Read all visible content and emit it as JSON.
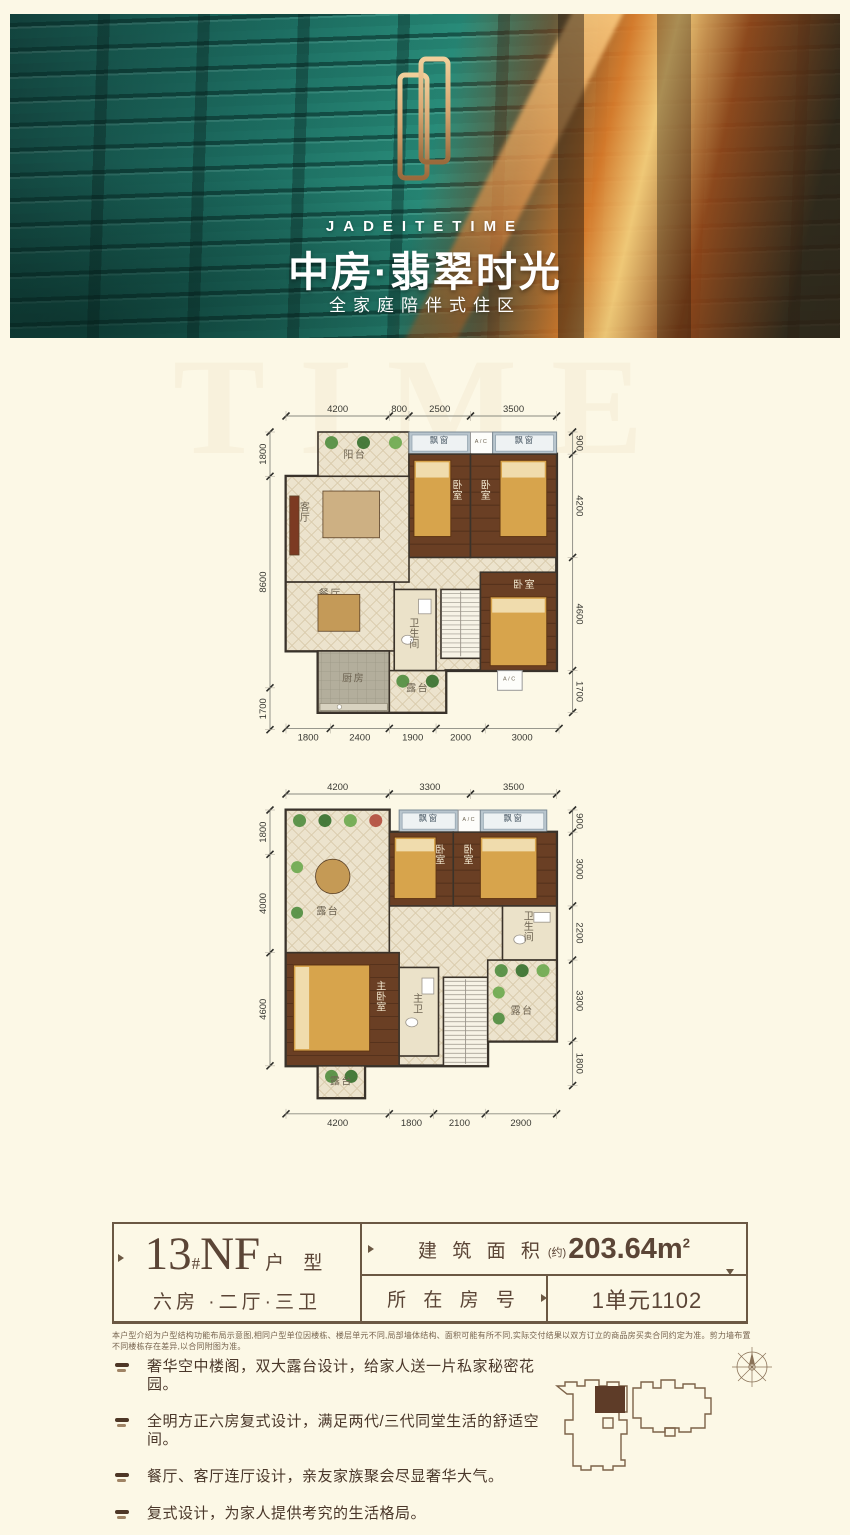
{
  "banner": {
    "en_title": "JADEITETIME",
    "cn_title": "中房·翡翠时光",
    "cn_subtitle": "全家庭陪伴式住区"
  },
  "watermark": "TIME",
  "colors": {
    "accent_brown": "#6b5843",
    "gold": "#d8a772",
    "wood": "#6a3f24",
    "teal": "#1d6e62",
    "orange": "#e27c28"
  },
  "plans": [
    {
      "name": "upper-floor-plan",
      "dims": {
        "top": [
          "4200",
          "800",
          "2500",
          "3500"
        ],
        "left": [
          "1800",
          "8600",
          "1700"
        ],
        "right": [
          "900",
          "4200",
          "4600",
          "1700"
        ],
        "bottom": [
          "1800",
          "2400",
          "1900",
          "2000",
          "3000"
        ]
      },
      "bodyH": 11400,
      "bodyPts": [
        [
          0,
          1800
        ],
        [
          5000,
          1800
        ],
        [
          5000,
          900
        ],
        [
          11000,
          900
        ],
        [
          11000,
          9700
        ],
        [
          6500,
          9700
        ],
        [
          6500,
          11400
        ],
        [
          1300,
          11400
        ],
        [
          1300,
          8900
        ],
        [
          0,
          8900
        ]
      ],
      "rooms": [
        {
          "label": "阳台",
          "x": 1300,
          "y": 0,
          "w": 3700,
          "h": 1800,
          "type": "tile-plants",
          "lx": 2800,
          "ly": 1050
        },
        {
          "label": "飘窗",
          "x": 5000,
          "y": 0,
          "w": 2500,
          "h": 900,
          "type": "bay"
        },
        {
          "label": "A/C",
          "x": 7500,
          "y": 0,
          "w": 900,
          "h": 900,
          "type": "ac"
        },
        {
          "label": "飘窗",
          "x": 8400,
          "y": 0,
          "w": 2600,
          "h": 900,
          "type": "bay"
        },
        {
          "label": "卧室",
          "x": 5000,
          "y": 900,
          "w": 2500,
          "h": 4200,
          "type": "wood",
          "vert": true,
          "lx": 7000,
          "ly": 2300,
          "bed": [
            5200,
            1150,
            1500,
            3100,
            "top"
          ]
        },
        {
          "label": "卧室",
          "x": 7500,
          "y": 900,
          "w": 3500,
          "h": 4200,
          "type": "wood",
          "vert": true,
          "lx": 8150,
          "ly": 2300,
          "bed": [
            8700,
            1150,
            1900,
            3100,
            "top"
          ]
        },
        {
          "label": "卧室",
          "x": 7900,
          "y": 5700,
          "w": 3100,
          "h": 4000,
          "type": "wood",
          "vert": false,
          "lx": 9700,
          "ly": 6350,
          "bed": [
            8300,
            6700,
            2300,
            2800,
            "top"
          ]
        },
        {
          "label": "客厅",
          "x": 0,
          "y": 1800,
          "w": 5000,
          "h": 4300,
          "type": "tile",
          "vert": true,
          "lx": 800,
          "ly": 3200
        },
        {
          "label": "餐厅",
          "x": 0,
          "y": 6100,
          "w": 4400,
          "h": 2800,
          "type": "tile",
          "lx": 1800,
          "ly": 6700
        },
        {
          "label": "卫生间",
          "x": 4400,
          "y": 6400,
          "w": 1700,
          "h": 3300,
          "type": "bath",
          "vert": true,
          "lx": 5250,
          "ly": 7900
        },
        {
          "label": "",
          "x": 6300,
          "y": 6400,
          "w": 1600,
          "h": 2800,
          "type": "stairs"
        },
        {
          "label": "厨房",
          "x": 1300,
          "y": 8900,
          "w": 2900,
          "h": 2500,
          "type": "kitchen",
          "lx": 2750,
          "ly": 10150
        },
        {
          "label": "露台",
          "x": 4200,
          "y": 9700,
          "w": 2300,
          "h": 1700,
          "type": "tile-plants",
          "lx": 5350,
          "ly": 10550
        },
        {
          "label": "A/C",
          "x": 8600,
          "y": 9700,
          "w": 1000,
          "h": 800,
          "type": "ac"
        }
      ],
      "deco": [
        {
          "t": "rect",
          "x": 1500,
          "y": 2400,
          "w": 2300,
          "h": 1900,
          "f": "#cdb083"
        },
        {
          "t": "rect",
          "x": 150,
          "y": 2600,
          "w": 380,
          "h": 2400,
          "f": "#7c3a22"
        },
        {
          "t": "rect",
          "x": 1300,
          "y": 6600,
          "w": 1700,
          "h": 1500,
          "f": "#c49a58"
        }
      ]
    },
    {
      "name": "lower-floor-plan",
      "dims": {
        "top": [
          "4200",
          "3300",
          "3500"
        ],
        "left": [
          "1800",
          "4000",
          "4600"
        ],
        "right": [
          "900",
          "3000",
          "2200",
          "3300",
          "1800"
        ],
        "bottom": [
          "4200",
          "1800",
          "2100",
          "2900"
        ]
      },
      "bodyH": 11700,
      "bodyPts": [
        [
          0,
          0
        ],
        [
          4200,
          0
        ],
        [
          4200,
          900
        ],
        [
          11000,
          900
        ],
        [
          11000,
          9400
        ],
        [
          8200,
          9400
        ],
        [
          8200,
          10400
        ],
        [
          3200,
          10400
        ],
        [
          3200,
          11700
        ],
        [
          1300,
          11700
        ],
        [
          1300,
          10400
        ],
        [
          0,
          10400
        ]
      ],
      "rooms": [
        {
          "label": "露台",
          "x": 0,
          "y": 0,
          "w": 4200,
          "h": 5800,
          "type": "tile-plants",
          "lx": 1700,
          "ly": 4250
        },
        {
          "label": "飘窗",
          "x": 4600,
          "y": 0,
          "w": 2400,
          "h": 900,
          "type": "bay"
        },
        {
          "label": "A/C",
          "x": 7000,
          "y": 0,
          "w": 900,
          "h": 900,
          "type": "ac"
        },
        {
          "label": "飘窗",
          "x": 7900,
          "y": 0,
          "w": 2700,
          "h": 900,
          "type": "bay"
        },
        {
          "label": "卧室",
          "x": 4200,
          "y": 900,
          "w": 2600,
          "h": 3000,
          "type": "wood",
          "vert": true,
          "lx": 6300,
          "ly": 1750,
          "bed": [
            4400,
            1100,
            1700,
            2500,
            "top"
          ]
        },
        {
          "label": "卧室",
          "x": 6800,
          "y": 900,
          "w": 4200,
          "h": 3000,
          "type": "wood",
          "vert": true,
          "lx": 7450,
          "ly": 1750,
          "bed": [
            7900,
            1100,
            2300,
            2500,
            "top"
          ]
        },
        {
          "label": "卫生间",
          "x": 8800,
          "y": 3900,
          "w": 2200,
          "h": 2200,
          "type": "bath",
          "vert": true,
          "lx": 9900,
          "ly": 4450
        },
        {
          "label": "主卧室",
          "x": 0,
          "y": 5800,
          "w": 4600,
          "h": 4600,
          "type": "wood",
          "vert": true,
          "lx": 3900,
          "ly": 7300,
          "bed": [
            300,
            6300,
            3100,
            3500,
            "left"
          ]
        },
        {
          "label": "主卫",
          "x": 4600,
          "y": 6400,
          "w": 1600,
          "h": 3600,
          "type": "bath",
          "vert": true,
          "lx": 5400,
          "ly": 7800
        },
        {
          "label": "",
          "x": 6400,
          "y": 6800,
          "w": 1800,
          "h": 3600,
          "type": "stairs"
        },
        {
          "label": "露台",
          "x": 8200,
          "y": 6100,
          "w": 2800,
          "h": 3300,
          "type": "tile-plants",
          "lx": 9600,
          "ly": 8300
        },
        {
          "label": "露台",
          "x": 1300,
          "y": 10400,
          "w": 1900,
          "h": 1300,
          "type": "tile-plants",
          "lx": 2250,
          "ly": 11150
        }
      ],
      "deco": [
        {
          "t": "circle",
          "cx": 1900,
          "cy": 2700,
          "r": 700,
          "f": "#c59a55"
        }
      ]
    }
  ],
  "info": {
    "block": "13",
    "hash": "#",
    "unit_type": "NF",
    "suffix": "户 型",
    "layout": "六房 ·二厅·三卫",
    "area_label": "建 筑 面 积",
    "area_note": "(约)",
    "area_value": "203.64m",
    "area_exp": "2",
    "room_label": "所 在 房 号",
    "room_value": "1单元1102"
  },
  "disclaimer": "本户型介绍为户型结构功能布局示意图,相同户型单位因楼栋、楼层单元不同,局部墙体结构、面积可能有所不同,实际交付结果以双方订立的商品房买卖合同约定为准。剪力墙布置不同楼栋存在差异,以合同附图为准。",
  "features": [
    "奢华空中楼阁，双大露台设计，给家人送一片私家秘密花园。",
    "全明方正六房复式设计，满足两代/三代同堂生活的舒适空间。",
    "餐厅、客厅连厅设计，亲友家族聚会尽显奢华大气。",
    "复式设计，为家人提供考究的生活格局。"
  ]
}
